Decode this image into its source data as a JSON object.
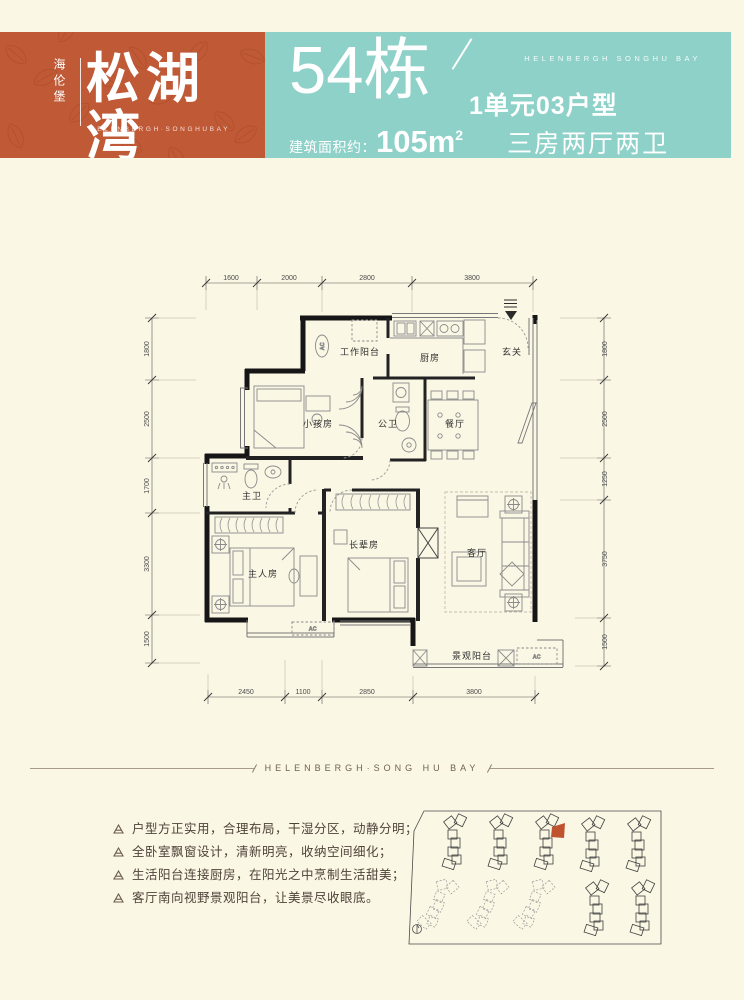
{
  "header": {
    "brand": {
      "vertical_name": "海伦堡",
      "name": "松湖湾",
      "name_en": "HELENBERGH·SONGHUBAY"
    },
    "band_en": "HELENBERGH  SONGHU BAY",
    "building": "54栋",
    "unit": "1单元03户型",
    "area_label": "建筑面积约：",
    "area_value": "105m",
    "area_sup": "2",
    "layout": "三房两厅两卫"
  },
  "plan": {
    "rooms": {
      "work_balcony": "工作阳台",
      "kitchen": "厨房",
      "foyer": "玄关",
      "kids_room": "小孩房",
      "guest_bath": "公卫",
      "dining": "餐厅",
      "master_bath": "主卫",
      "master_room": "主人房",
      "elder_room": "长辈房",
      "living": "客厅",
      "view_balcony": "景观阳台"
    },
    "ac_label": "AC",
    "dims": {
      "top": [
        "1600",
        "2000",
        "2800",
        "3800"
      ],
      "bottom": [
        "2450",
        "1100",
        "2850",
        "3800"
      ],
      "left": [
        "1800",
        "2500",
        "1700",
        "3300",
        "1500"
      ],
      "right": [
        "1800",
        "2500",
        "1250",
        "3750",
        "1500"
      ]
    }
  },
  "divider": {
    "text": "HELENBERGH·SONG HU BAY"
  },
  "features": [
    "户型方正实用，合理布局，干湿分区，动静分明；",
    "全卧室飘窗设计，清新明亮，收纳空间细化；",
    "生活阳台连接厨房，在阳光之中烹制生活甜美；",
    "客厅南向视野景观阳台，让美景尽收眼底。"
  ],
  "colors": {
    "accent_orange": "#c05936",
    "teal": "#8ed1c8",
    "cream": "#fbf7e5",
    "highlight_building": "#c0532f"
  }
}
